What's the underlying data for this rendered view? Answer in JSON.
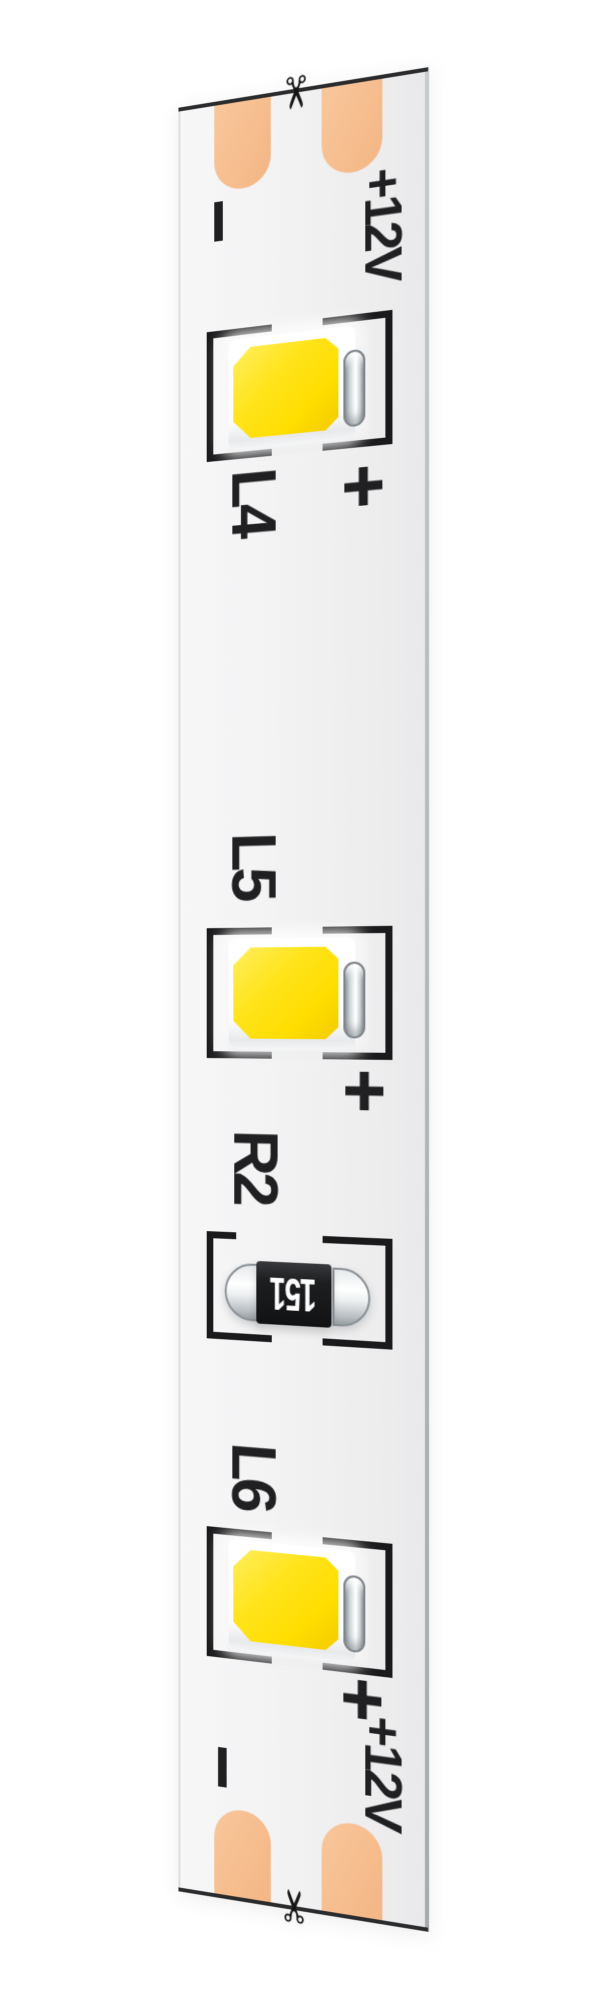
{
  "background_color": "#ffffff",
  "strip": {
    "pcb_color": "#f1f1f2",
    "pad_copper_color": "#f6bd8e",
    "silkscreen_color": "#202023",
    "led_emitter_color": "#ffe41c",
    "top_terminal": {
      "scissors_icon": "✂",
      "minus_label": "−",
      "voltage_label": "+12V",
      "pad_count": 2
    },
    "components": {
      "leds": [
        {
          "ref": "L4",
          "polarity_label": "+"
        },
        {
          "ref": "L5",
          "polarity_label": "+"
        },
        {
          "ref": "L6",
          "polarity_label": "+"
        }
      ],
      "resistor": {
        "ref": "R2",
        "code": "151"
      }
    },
    "bottom_terminal": {
      "polarity_label": "+",
      "voltage_label": "+12V",
      "minus_label": "−",
      "scissors_icon": "✂",
      "pad_count": 2
    }
  }
}
